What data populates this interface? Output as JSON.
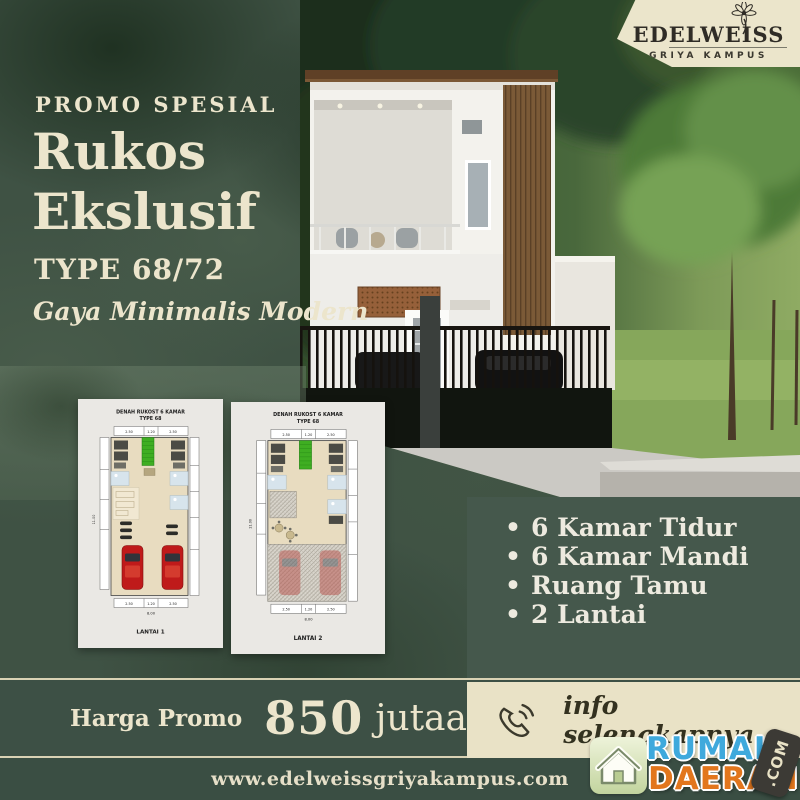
{
  "brand": {
    "name": "EDELWEISS",
    "tagline": "GRIYA KAMPUS"
  },
  "headline": {
    "eyebrow": "PROMO SPESIAL",
    "title_line1": "Rukos",
    "title_line2": "Ekslusif",
    "type": "TYPE 68/72",
    "style": "Gaya Minimalis Modern"
  },
  "plans": [
    {
      "title_line1": "DENAH RUKOST 6 KAMAR",
      "title_line2": "TYPE 68",
      "floor_label": "LANTAI 1",
      "dims_top": [
        "2.50",
        "1.20",
        "2.50"
      ],
      "dims_bottom": [
        "2.50",
        "1.20",
        "2.50"
      ],
      "dim_width_total": "8.00",
      "dim_height_total": "11.00"
    },
    {
      "title_line1": "DENAH RUKOST 6 KAMAR",
      "title_line2": "TYPE 68",
      "floor_label": "LANTAI 2",
      "dims_top": [
        "2.50",
        "1.20",
        "2.50"
      ],
      "dims_bottom": [
        "2.50",
        "1.20",
        "2.50"
      ],
      "dim_width_total": "8.00",
      "dim_height_total": "11.00"
    }
  ],
  "features": {
    "bullet": "•",
    "items": [
      "6 Kamar Tidur",
      "6 Kamar Mandi",
      "Ruang Tamu",
      "2 Lantai"
    ]
  },
  "price": {
    "label": "Harga Promo",
    "amount": "850",
    "unit": "jutaan"
  },
  "contact": {
    "cta": "info selengkapnya",
    "icon": "phone-icon"
  },
  "footer": {
    "website": "www.edelweissgriyakampus.com"
  },
  "watermark": {
    "word1": "RUMAH",
    "word2": "DAERAH",
    "suffix": ".COM",
    "icon": "house-icon"
  },
  "colors": {
    "background_green": "#3f5244",
    "panel_green": "#45584c",
    "strip_green": "#3d5045",
    "footer_green": "#3a4e43",
    "cream": "#ece5cc",
    "banner_cream": "#ebe5cb",
    "logo_blue": "#3fa9dc",
    "logo_orange": "#e2761d",
    "plan_stair_green": "#3fae22",
    "plan_car_red": "#bf1a1a"
  }
}
